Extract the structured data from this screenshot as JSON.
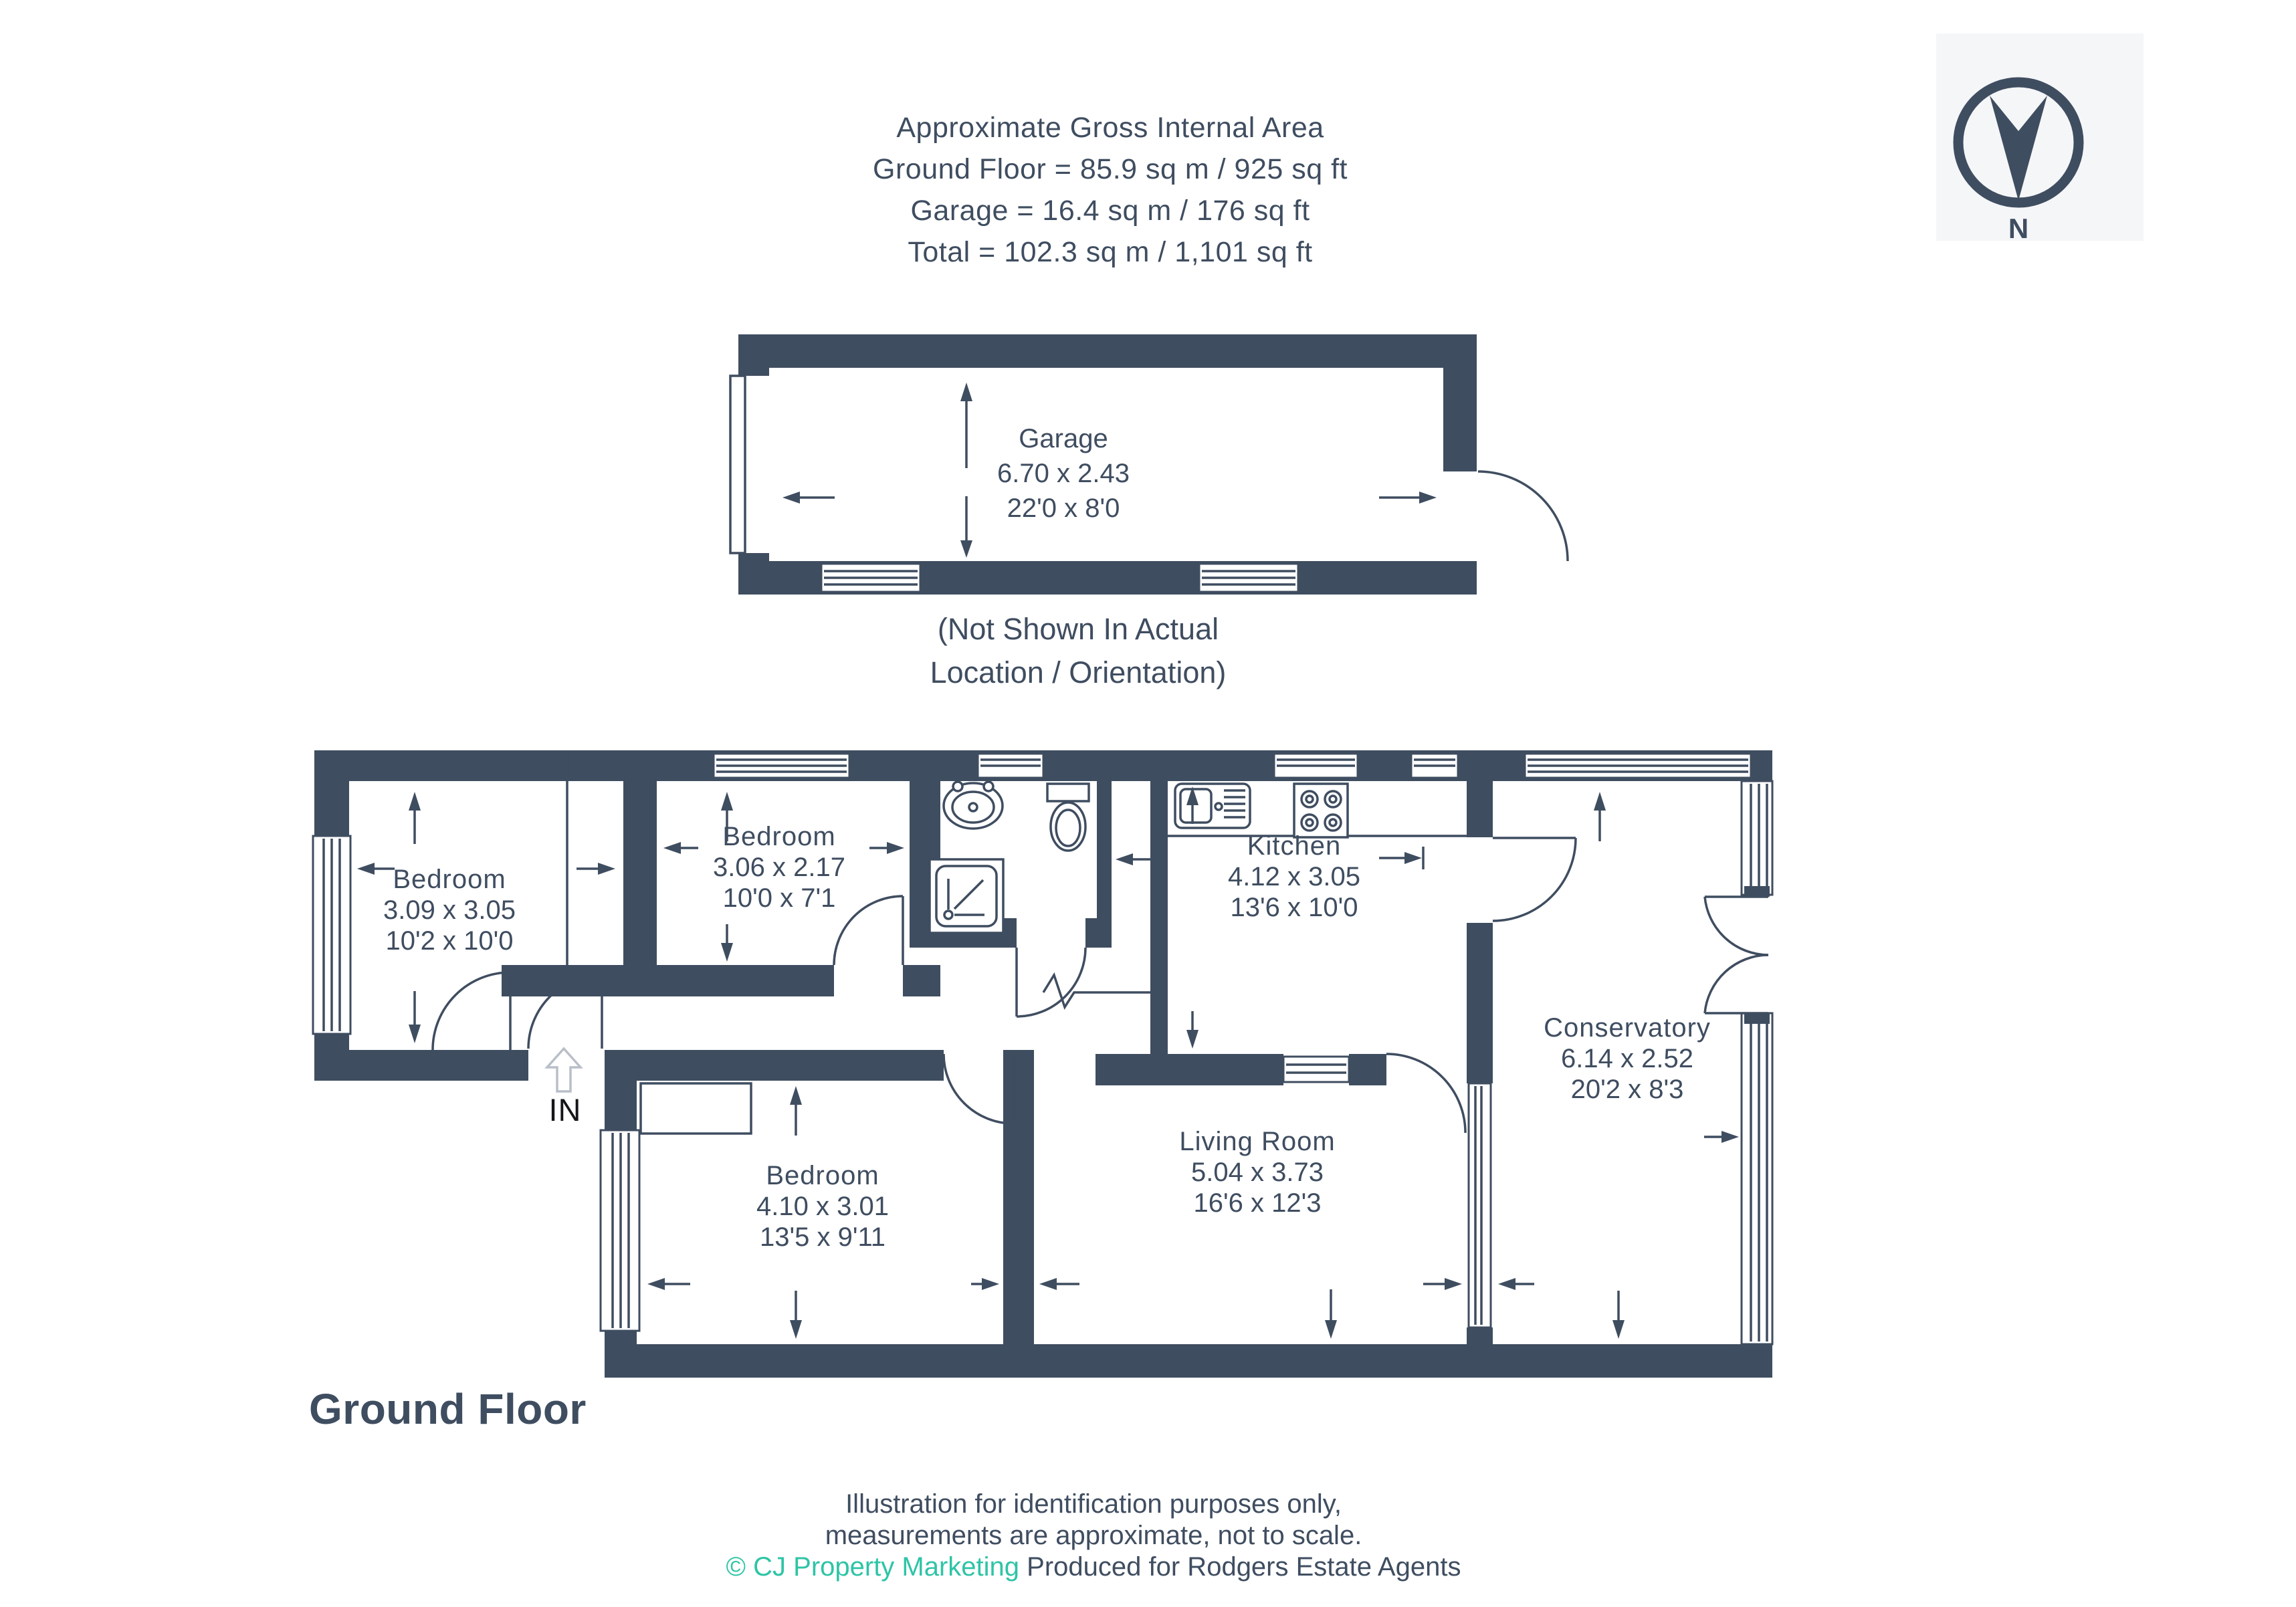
{
  "header": {
    "line1": "Approximate Gross Internal Area",
    "line2": "Ground Floor = 85.9 sq m / 925 sq ft",
    "line3": "Garage = 16.4 sq m / 176 sq ft",
    "line4": "Total = 102.3 sq m / 1,101 sq ft"
  },
  "compass": {
    "label": "N"
  },
  "garage": {
    "name": "Garage",
    "dims_m": "6.70 x 2.43",
    "dims_ft": "22'0 x 8'0",
    "note_line1": "(Not Shown In Actual",
    "note_line2": "Location / Orientation)"
  },
  "rooms": [
    {
      "name": "Bedroom",
      "dims_m": "3.09 x 3.05",
      "dims_ft": "10'2 x 10'0"
    },
    {
      "name": "Bedroom",
      "dims_m": "3.06 x 2.17",
      "dims_ft": "10'0 x 7'1"
    },
    {
      "name": "Kitchen",
      "dims_m": "4.12 x 3.05",
      "dims_ft": "13'6 x 10'0"
    },
    {
      "name": "Conservatory",
      "dims_m": "6.14 x 2.52",
      "dims_ft": "20'2 x 8'3"
    },
    {
      "name": "Living Room",
      "dims_m": "5.04 x 3.73",
      "dims_ft": "16'6 x 12'3"
    },
    {
      "name": "Bedroom",
      "dims_m": "4.10 x 3.01",
      "dims_ft": "13'5 x 9'11"
    }
  ],
  "entrance": {
    "label": "IN"
  },
  "floor_title": "Ground Floor",
  "footer": {
    "line1": "Illustration for identification purposes only,",
    "line2": "measurements are approximate, not to scale.",
    "credit": "© CJ Property Marketing",
    "produced": "Produced for Rodgers Estate Agents"
  },
  "colors": {
    "wall": "#3f4d60",
    "text": "#3f4d60",
    "credit_teal": "#2ec4a6",
    "entrance_text": "#141619",
    "entrance_arrow": "#b9bfc9",
    "compass_tile": "#f5f6f8"
  }
}
